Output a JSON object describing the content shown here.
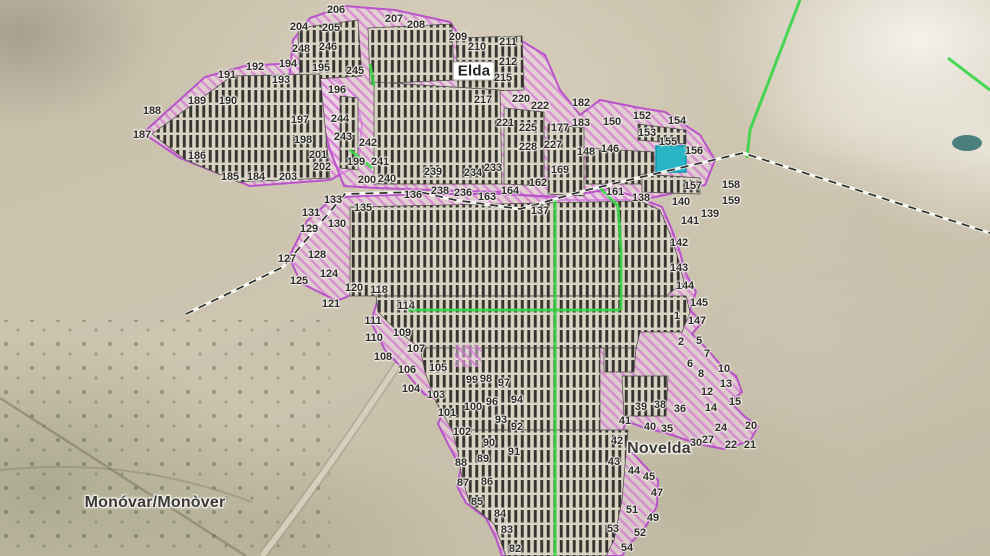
{
  "map": {
    "places": [
      {
        "name": "Elda",
        "x": 474,
        "y": 71,
        "boxed": true
      },
      {
        "name": "Novelda",
        "x": 659,
        "y": 449,
        "boxed": false
      },
      {
        "name": "Monóvar/Monòver",
        "x": 155,
        "y": 503,
        "boxed": false
      }
    ],
    "highlighted_parcel": {
      "x": 656,
      "y": 146,
      "w": 30,
      "h": 26,
      "color": "#2ab5c6",
      "outline": "#0f9aae"
    },
    "colors": {
      "zone_hatch_pink": "#d676d3",
      "zone_outline_magenta": "#b84ecb",
      "panel_dark": "#35342f",
      "path_green": "#37d546",
      "boundary_dash_black": "#2e2e2e",
      "highlight_cyan": "#2ab5c6"
    },
    "parcel_labels": [
      [
        "206",
        336,
        10
      ],
      [
        "204",
        299,
        27
      ],
      [
        "205",
        331,
        28
      ],
      [
        "207",
        394,
        19
      ],
      [
        "208",
        416,
        25
      ],
      [
        "209",
        458,
        37
      ],
      [
        "210",
        477,
        47
      ],
      [
        "211",
        508,
        42
      ],
      [
        "212",
        508,
        62
      ],
      [
        "215",
        503,
        78
      ],
      [
        "217",
        483,
        100
      ],
      [
        "220",
        521,
        99
      ],
      [
        "222",
        540,
        106
      ],
      [
        "248",
        301,
        49
      ],
      [
        "246",
        328,
        47
      ],
      [
        "245",
        355,
        71
      ],
      [
        "244",
        340,
        119
      ],
      [
        "243",
        343,
        137
      ],
      [
        "242",
        368,
        143
      ],
      [
        "241",
        380,
        162
      ],
      [
        "240",
        387,
        179
      ],
      [
        "239",
        433,
        172
      ],
      [
        "238",
        440,
        191
      ],
      [
        "236",
        463,
        193
      ],
      [
        "234",
        473,
        173
      ],
      [
        "233",
        493,
        168
      ],
      [
        "228",
        528,
        147
      ],
      [
        "227",
        553,
        145
      ],
      [
        "225",
        528,
        128
      ],
      [
        "221",
        505,
        123
      ],
      [
        "177",
        560,
        128
      ],
      [
        "182",
        581,
        103
      ],
      [
        "183",
        581,
        123
      ],
      [
        "150",
        612,
        122
      ],
      [
        "152",
        642,
        116
      ],
      [
        "153",
        647,
        133
      ],
      [
        "154",
        677,
        121
      ],
      [
        "155",
        668,
        142
      ],
      [
        "156",
        694,
        151
      ],
      [
        "157",
        693,
        186
      ],
      [
        "158",
        731,
        185
      ],
      [
        "159",
        731,
        201
      ],
      [
        "161",
        615,
        192
      ],
      [
        "162",
        538,
        183
      ],
      [
        "163",
        487,
        197
      ],
      [
        "164",
        510,
        191
      ],
      [
        "169",
        560,
        170
      ],
      [
        "148",
        586,
        152
      ],
      [
        "146",
        610,
        149
      ],
      [
        "136",
        413,
        195
      ],
      [
        "137",
        540,
        211
      ],
      [
        "138",
        641,
        198
      ],
      [
        "139",
        710,
        214
      ],
      [
        "140",
        681,
        202
      ],
      [
        "141",
        690,
        221
      ],
      [
        "142",
        679,
        243
      ],
      [
        "143",
        679,
        268
      ],
      [
        "144",
        685,
        286
      ],
      [
        "145",
        699,
        303
      ],
      [
        "147",
        697,
        321
      ],
      [
        "133",
        333,
        200
      ],
      [
        "135",
        363,
        208
      ],
      [
        "131",
        311,
        213
      ],
      [
        "130",
        337,
        224
      ],
      [
        "129",
        309,
        229
      ],
      [
        "128",
        317,
        255
      ],
      [
        "127",
        287,
        259
      ],
      [
        "125",
        299,
        281
      ],
      [
        "124",
        329,
        274
      ],
      [
        "121",
        331,
        304
      ],
      [
        "120",
        354,
        288
      ],
      [
        "118",
        379,
        290
      ],
      [
        "114",
        406,
        306
      ],
      [
        "111",
        373,
        321
      ],
      [
        "110",
        374,
        338
      ],
      [
        "109",
        402,
        333
      ],
      [
        "108",
        383,
        357
      ],
      [
        "107",
        416,
        349
      ],
      [
        "106",
        407,
        370
      ],
      [
        "105",
        438,
        368
      ],
      [
        "104",
        411,
        389
      ],
      [
        "103",
        436,
        395
      ],
      [
        "102",
        462,
        432
      ],
      [
        "101",
        447,
        413
      ],
      [
        "100",
        473,
        407
      ],
      [
        "99",
        472,
        380
      ],
      [
        "98",
        486,
        379
      ],
      [
        "97",
        504,
        383
      ],
      [
        "96",
        492,
        402
      ],
      [
        "94",
        517,
        400
      ],
      [
        "93",
        501,
        420
      ],
      [
        "92",
        517,
        427
      ],
      [
        "91",
        514,
        452
      ],
      [
        "90",
        489,
        443
      ],
      [
        "89",
        483,
        459
      ],
      [
        "88",
        461,
        463
      ],
      [
        "87",
        463,
        483
      ],
      [
        "86",
        487,
        482
      ],
      [
        "85",
        477,
        502
      ],
      [
        "84",
        500,
        514
      ],
      [
        "83",
        507,
        530
      ],
      [
        "82",
        515,
        549
      ],
      [
        "191",
        227,
        75
      ],
      [
        "192",
        255,
        67
      ],
      [
        "193",
        281,
        80
      ],
      [
        "194",
        288,
        64
      ],
      [
        "195",
        321,
        68
      ],
      [
        "196",
        337,
        90
      ],
      [
        "197",
        300,
        120
      ],
      [
        "198",
        303,
        140
      ],
      [
        "199",
        356,
        162
      ],
      [
        "200",
        367,
        180
      ],
      [
        "201",
        318,
        155
      ],
      [
        "202",
        322,
        167
      ],
      [
        "203",
        288,
        177
      ],
      [
        "184",
        256,
        177
      ],
      [
        "185",
        230,
        177
      ],
      [
        "186",
        197,
        156
      ],
      [
        "187",
        142,
        135
      ],
      [
        "188",
        152,
        111
      ],
      [
        "189",
        197,
        101
      ],
      [
        "190",
        228,
        101
      ],
      [
        "1",
        677,
        316
      ],
      [
        "2",
        681,
        342
      ],
      [
        "5",
        699,
        341
      ],
      [
        "6",
        690,
        364
      ],
      [
        "7",
        707,
        354
      ],
      [
        "8",
        701,
        374
      ],
      [
        "10",
        724,
        369
      ],
      [
        "12",
        707,
        392
      ],
      [
        "13",
        726,
        384
      ],
      [
        "14",
        711,
        408
      ],
      [
        "15",
        735,
        402
      ],
      [
        "20",
        751,
        426
      ],
      [
        "21",
        750,
        445
      ],
      [
        "22",
        731,
        445
      ],
      [
        "24",
        721,
        428
      ],
      [
        "27",
        708,
        440
      ],
      [
        "30",
        696,
        443
      ],
      [
        "35",
        667,
        429
      ],
      [
        "36",
        680,
        409
      ],
      [
        "38",
        660,
        405
      ],
      [
        "39",
        641,
        407
      ],
      [
        "40",
        650,
        427
      ],
      [
        "41",
        625,
        421
      ],
      [
        "42",
        617,
        441
      ],
      [
        "43",
        614,
        462
      ],
      [
        "44",
        634,
        471
      ],
      [
        "45",
        649,
        477
      ],
      [
        "47",
        657,
        493
      ],
      [
        "49",
        653,
        518
      ],
      [
        "51",
        632,
        510
      ],
      [
        "52",
        640,
        533
      ],
      [
        "53",
        613,
        529
      ],
      [
        "54",
        627,
        548
      ]
    ]
  }
}
